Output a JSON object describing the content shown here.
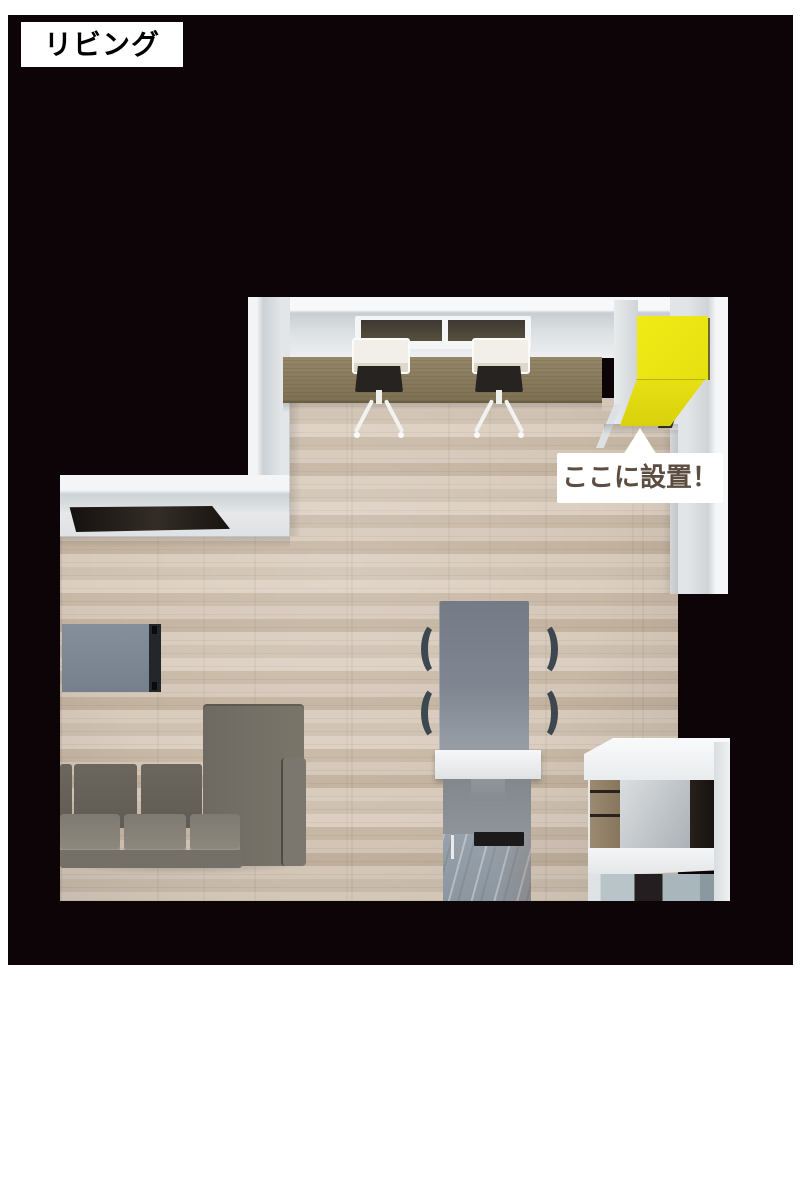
{
  "annotations": {
    "room_label": "リビング",
    "callout_text": "ここに設置！"
  },
  "colors": {
    "page_background": "#ffffff",
    "backdrop": "#0d0407",
    "label_background": "#ffffff",
    "label_text": "#000000",
    "callout_background": "#ffffff",
    "callout_text": "#5c4d40",
    "highlight_top": "#f0ea16",
    "highlight_front": "#d8d10c",
    "floor_wood": "#d3c5b5",
    "desk_wood": "#8a7c60",
    "wall": "#e8ebec",
    "sofa": "#6f6b63",
    "tv_board": "#7d8794",
    "dining_table": "#7e8590",
    "dining_chair": "#3c4750",
    "kitchen_counter": "#eef0f1"
  }
}
